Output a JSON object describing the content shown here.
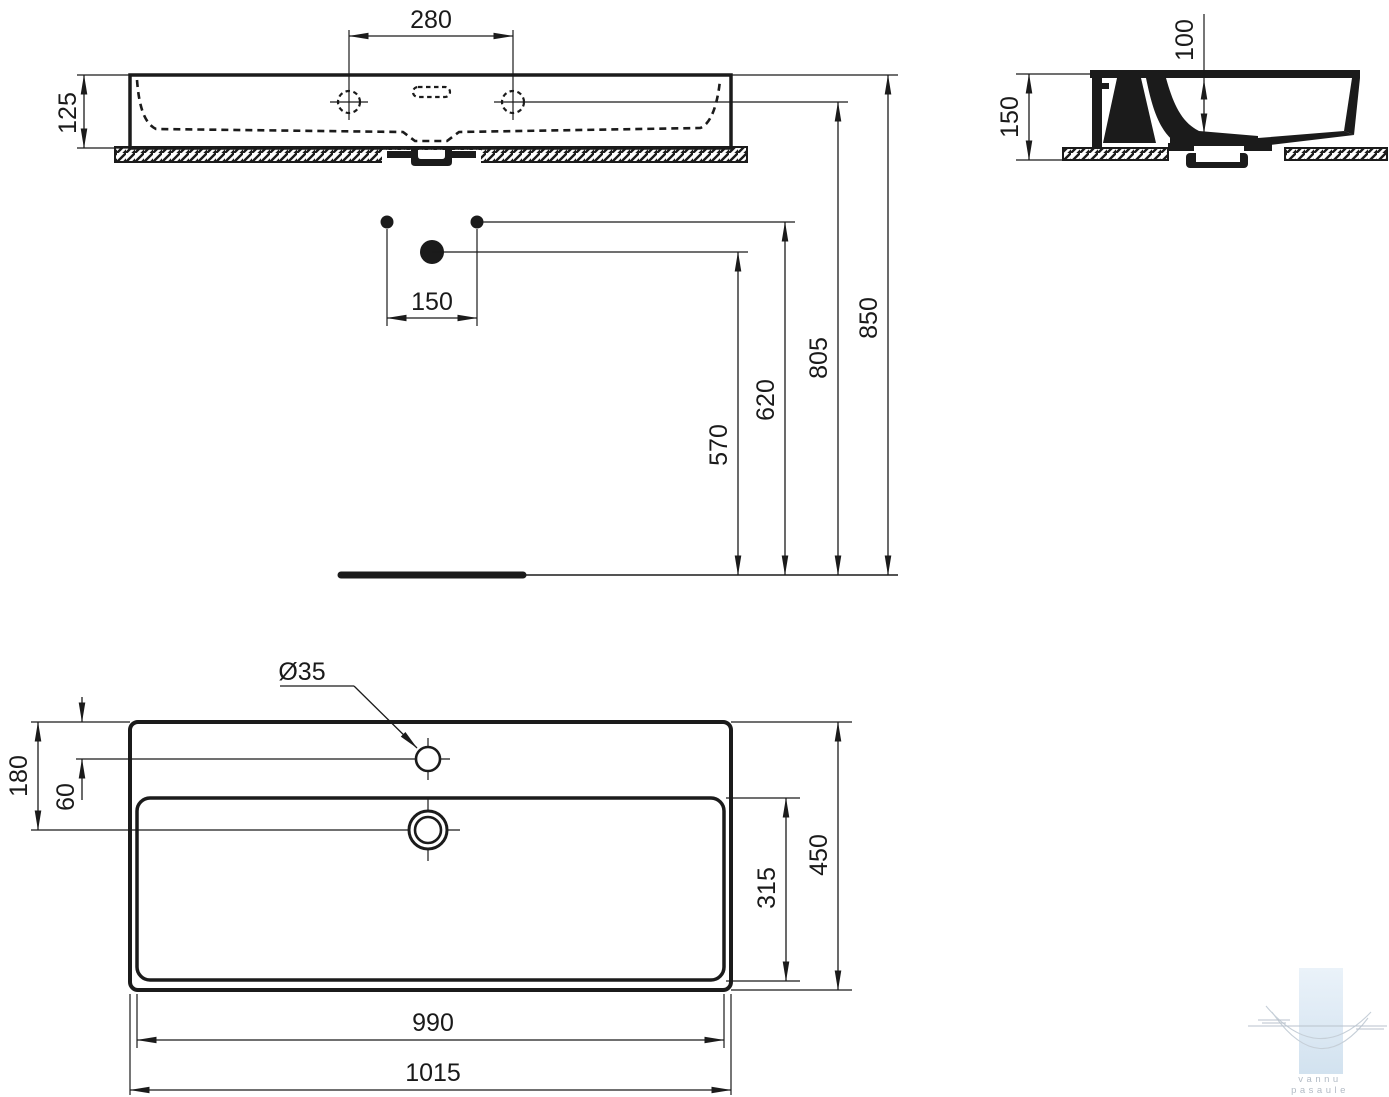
{
  "dims": {
    "front_tap_spacing": "280",
    "front_height": "125",
    "front_drain_offset": "150",
    "front_drain_height": "570",
    "front_supply_height": "620",
    "front_tap_height": "805",
    "front_rim_height": "850",
    "side_height": "150",
    "side_bowl_depth": "100",
    "plan_tap_hole_diameter": "Ø35",
    "plan_back_to_drain": "180",
    "plan_back_to_tap": "60",
    "plan_depth": "450",
    "plan_bowl_depth": "315",
    "plan_bowl_width": "990",
    "plan_width": "1015"
  },
  "watermark": {
    "line1": "vannu",
    "line2": "pasaule"
  },
  "colors": {
    "line": "#1b1b1b",
    "watermark_blue_top": "#eaf2f9",
    "watermark_blue_bottom": "#d2e2ef",
    "watermark_gray": "#b2bbc5"
  }
}
